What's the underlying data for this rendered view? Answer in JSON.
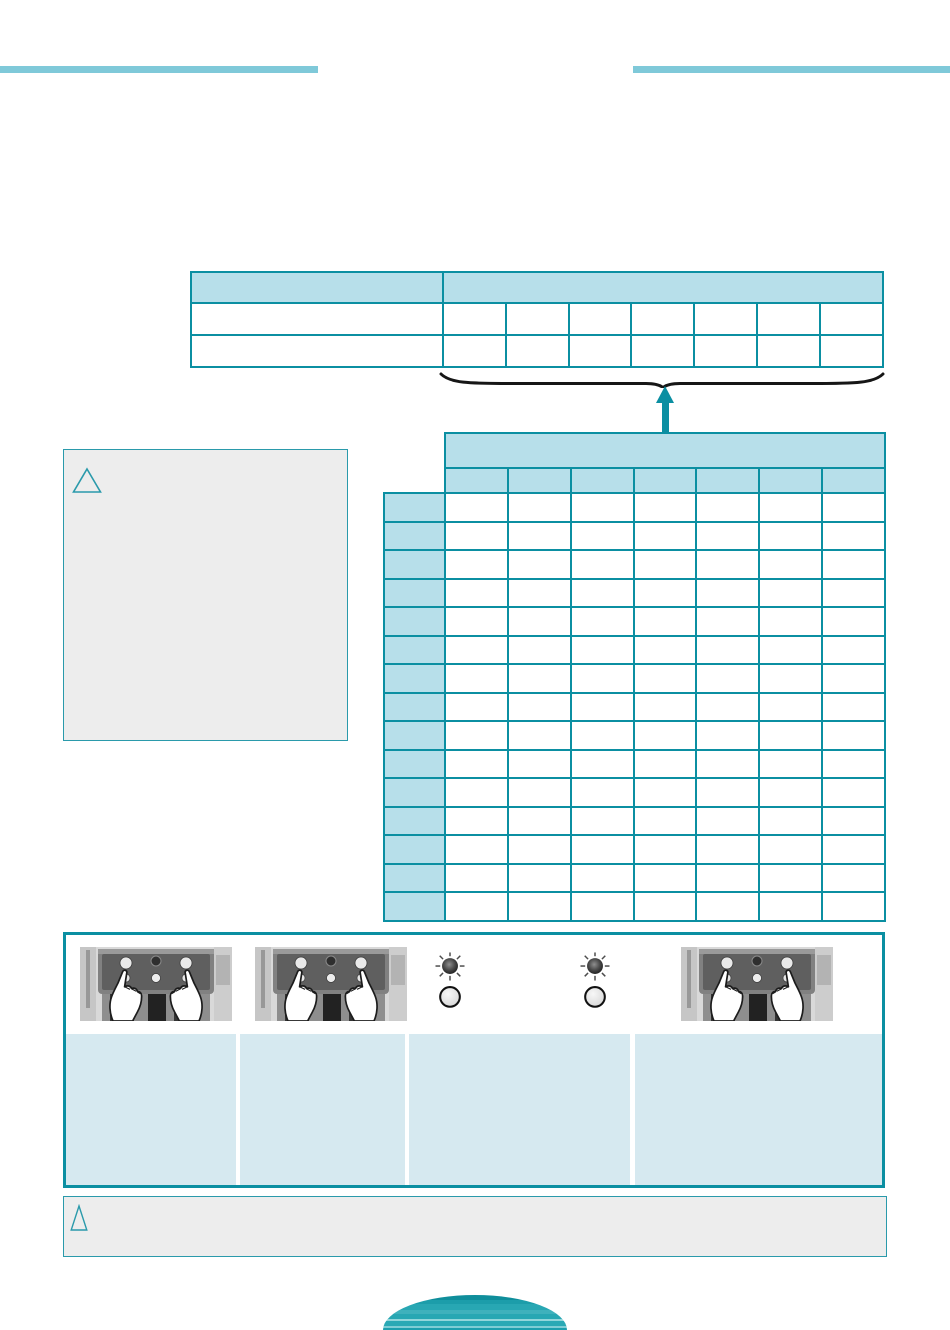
{
  "page": {
    "kind": "scanned-manual-page",
    "width_px": 950,
    "height_px": 1330,
    "text_layer_rendered": false
  },
  "colors": {
    "page_bg": "#ffffff",
    "teal": "#0b8fa2",
    "teal_light_bar": "#7fc9d9",
    "table_header_fill": "#b7dfea",
    "caption_box_fill": "#d6e9f0",
    "gray_box_fill": "#ededed",
    "gray_box_border": "#2a9aab",
    "brace_ink": "#161616",
    "arrow_teal": "#0b8fa2"
  },
  "header": {
    "left_rule_present": true,
    "right_rule_present": true
  },
  "tables": {
    "summary": {
      "value_columns": 7,
      "body_rows": 2,
      "header_group_merged": true,
      "all_cells_blank": true
    },
    "detail": {
      "value_columns": 7,
      "body_rows": 15,
      "row_header_column": true,
      "group_header_band": true,
      "all_cells_blank": true
    }
  },
  "annotation": {
    "brace": "horizontal-brace-under-summary-value-columns",
    "arrow": "teal-up-arrow-from-detail-table-header-to-brace"
  },
  "callouts": {
    "caution_box": {
      "icon": "warning-triangle-icon",
      "body_text": ""
    },
    "note_box": {
      "icon": "warning-triangle-icon",
      "body_text": ""
    }
  },
  "instruction_panel": {
    "items": [
      {
        "type": "photo",
        "name": "press-two-buttons-photo"
      },
      {
        "type": "photo",
        "name": "press-two-buttons-photo"
      },
      {
        "type": "led-pair",
        "top": "led-blinking",
        "bottom": "led-off"
      },
      {
        "type": "led-pair",
        "top": "led-blinking",
        "bottom": "led-off"
      },
      {
        "type": "photo",
        "name": "press-two-buttons-photo"
      }
    ],
    "caption_boxes": [
      {
        "text": ""
      },
      {
        "text": ""
      },
      {
        "text": ""
      },
      {
        "text": ""
      }
    ]
  },
  "footer": {
    "decoration": "striped-teal-half-ellipse"
  }
}
